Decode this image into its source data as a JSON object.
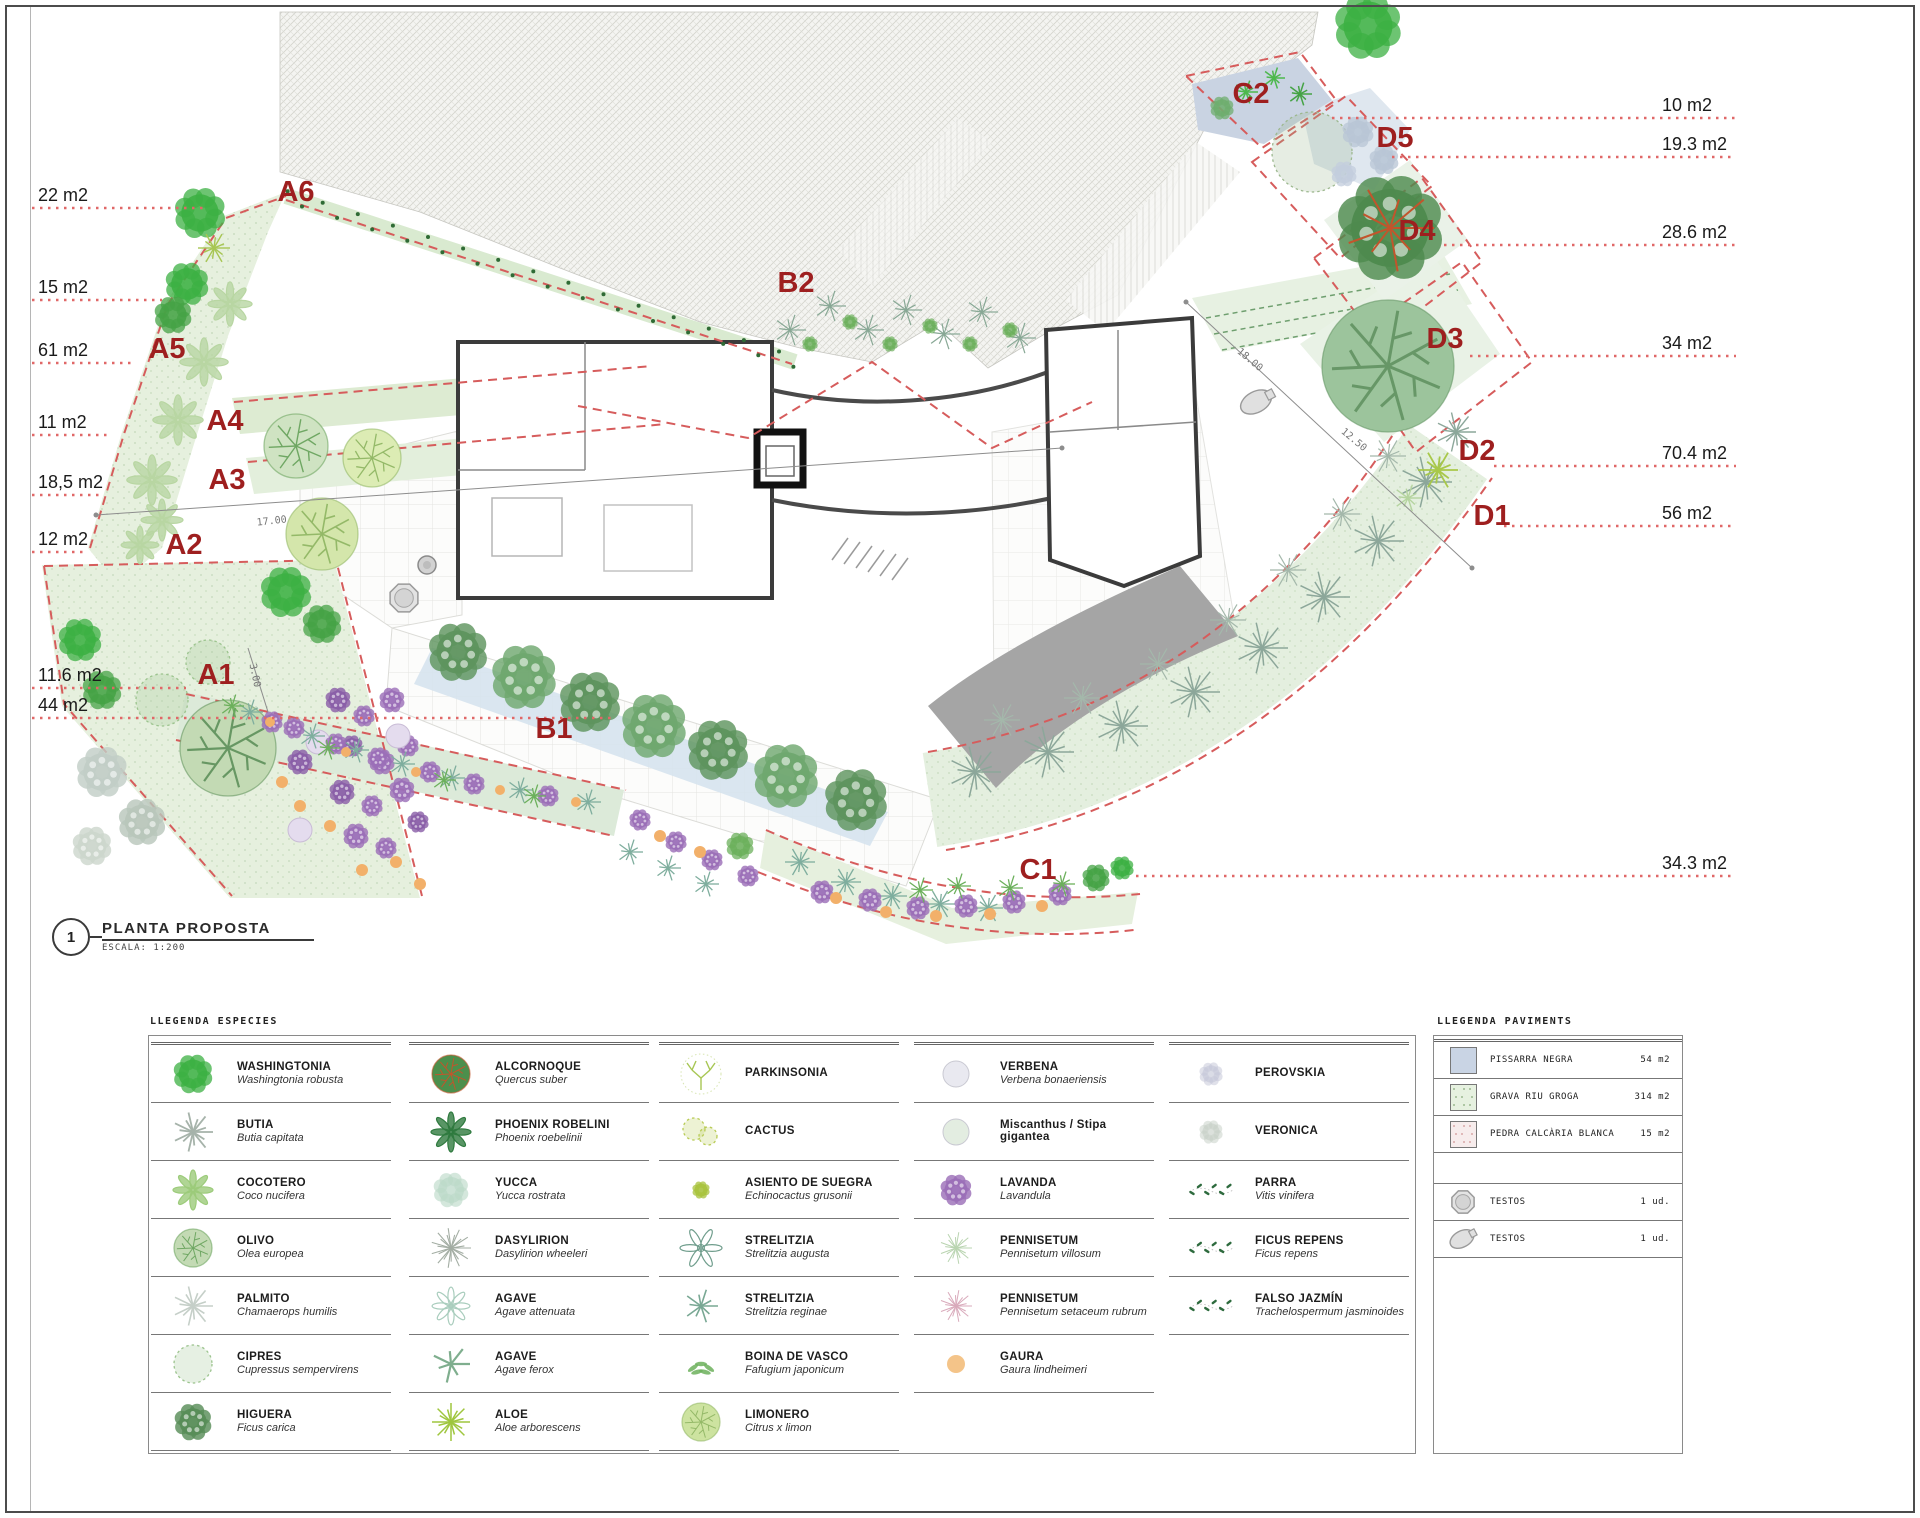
{
  "title_block": {
    "number": "1",
    "title": "PLANTA PROPOSTA",
    "scale_label": "ESCALA:  1:200"
  },
  "colors": {
    "zone_label": "#9e1f1f",
    "leader_line": "#e06868",
    "zone_dash": "#d65c5c"
  },
  "plan": {
    "zones": [
      {
        "id": "A1",
        "label": "A1",
        "x": 216,
        "y": 684
      },
      {
        "id": "A2",
        "label": "A2",
        "x": 184,
        "y": 554
      },
      {
        "id": "A3",
        "label": "A3",
        "x": 227,
        "y": 489
      },
      {
        "id": "A4",
        "label": "A4",
        "x": 225,
        "y": 430
      },
      {
        "id": "A5",
        "label": "A5",
        "x": 167,
        "y": 358
      },
      {
        "id": "A6",
        "label": "A6",
        "x": 296,
        "y": 201
      },
      {
        "id": "B1",
        "label": "B1",
        "x": 554,
        "y": 738
      },
      {
        "id": "B2",
        "label": "B2",
        "x": 796,
        "y": 292
      },
      {
        "id": "C1",
        "label": "C1",
        "x": 1038,
        "y": 879
      },
      {
        "id": "C2",
        "label": "C2",
        "x": 1251,
        "y": 103
      },
      {
        "id": "D1",
        "label": "D1",
        "x": 1492,
        "y": 525
      },
      {
        "id": "D2",
        "label": "D2",
        "x": 1477,
        "y": 460
      },
      {
        "id": "D3",
        "label": "D3",
        "x": 1445,
        "y": 348
      },
      {
        "id": "D4",
        "label": "D4",
        "x": 1417,
        "y": 240
      },
      {
        "id": "D5",
        "label": "D5",
        "x": 1395,
        "y": 147
      }
    ],
    "measurements_left": [
      {
        "label": "22 m2",
        "y": 201,
        "line_y": 208,
        "line_x2": 205
      },
      {
        "label": "15 m2",
        "y": 293,
        "line_y": 300,
        "line_x2": 162
      },
      {
        "label": "61 m2",
        "y": 356,
        "line_y": 363,
        "line_x2": 132
      },
      {
        "label": "11 m2",
        "y": 428,
        "line_y": 435,
        "line_x2": 112
      },
      {
        "label": "18,5 m2",
        "y": 488,
        "line_y": 495,
        "line_x2": 100
      },
      {
        "label": "12 m2",
        "y": 545,
        "line_y": 552,
        "line_x2": 86
      },
      {
        "label": "11.6 m2",
        "y": 681,
        "line_y": 688,
        "line_x2": 186
      },
      {
        "label": "44 m2",
        "y": 711,
        "line_y": 718,
        "line_x2": 612
      }
    ],
    "measurements_right": [
      {
        "label": "10 m2",
        "y": 111,
        "line_x1": 1332
      },
      {
        "label": "19.3 m2",
        "y": 150,
        "line_x1": 1392
      },
      {
        "label": "28.6 m2",
        "y": 238,
        "line_x1": 1444
      },
      {
        "label": "34 m2",
        "y": 349,
        "line_x1": 1470
      },
      {
        "label": "70.4 m2",
        "y": 459,
        "line_x1": 1494
      },
      {
        "label": "56 m2",
        "y": 519,
        "line_x1": 1504
      },
      {
        "label": "34.3 m2",
        "y": 869,
        "line_x1": 1136
      }
    ],
    "dimensions": [
      {
        "label": "17.00",
        "x": 272,
        "y": 524,
        "rot": -6
      },
      {
        "label": "3.00",
        "x": 252,
        "y": 676,
        "rot": 78
      },
      {
        "label": "12.50",
        "x": 1352,
        "y": 442,
        "rot": 40
      },
      {
        "label": "18.00",
        "x": 1248,
        "y": 362,
        "rot": 40
      }
    ]
  },
  "legend_species": {
    "title": "LLEGENDA ESPECIES",
    "columns": [
      {
        "rows": [
          {
            "name": "WASHINGTONIA",
            "latin": "Washingtonia robusta",
            "glyph": "blob-tree",
            "color": "#3cb043"
          },
          {
            "name": "BUTIA",
            "latin": "Butia capitata",
            "glyph": "palm-star",
            "color": "#a6b3aa"
          },
          {
            "name": "COCOTERO",
            "latin": "Coco nucifera",
            "glyph": "palm-fronds",
            "color": "#9ccb7a"
          },
          {
            "name": "OLIVO",
            "latin": "Olea europea",
            "glyph": "olive-tree",
            "color": "#c3dab4",
            "color2": "#6fa763"
          },
          {
            "name": "PALMITO",
            "latin": "Chamaerops humilis",
            "glyph": "snowflake-palm",
            "color": "#c5cfc8"
          },
          {
            "name": "CIPRES",
            "latin": "Cupressus sempervirens",
            "glyph": "dotted-tree",
            "color": "#9cc48e"
          },
          {
            "name": "HIGUERA",
            "latin": "Ficus carica",
            "glyph": "mottled-tree",
            "color": "#578d57"
          }
        ]
      },
      {
        "rows": [
          {
            "name": "ALCORNOQUE",
            "latin": "Quercus suber",
            "glyph": "cork-tree",
            "color": "#4c8f4c",
            "color2": "#c2552c"
          },
          {
            "name": "PHOENIX ROBELINI",
            "latin": "Phoenix roebelinii",
            "glyph": "palm-fronds",
            "color": "#2f7a3f"
          },
          {
            "name": "YUCCA",
            "latin": "Yucca rostrata",
            "glyph": "pompom",
            "color": "#bcd9c9"
          },
          {
            "name": "DASYLIRION",
            "latin": "Dasylirion wheeleri",
            "glyph": "starburst",
            "color": "#a3ada3"
          },
          {
            "name": "AGAVE",
            "latin": "Agave attenuata",
            "glyph": "agave-rosette",
            "color": "#a9cdbd"
          },
          {
            "name": "AGAVE",
            "latin": "Agave ferox",
            "glyph": "agave-blades",
            "color": "#7fae8e"
          },
          {
            "name": "ALOE",
            "latin": "Aloe arborescens",
            "glyph": "aloe-star",
            "color": "#9fc63e"
          }
        ]
      },
      {
        "rows": [
          {
            "name": "PARKINSONIA",
            "latin": "",
            "glyph": "parkinsonia-branches",
            "color": "#a7c653"
          },
          {
            "name": "CACTUS",
            "latin": "",
            "glyph": "cactus-pair",
            "color": "#b8cb55"
          },
          {
            "name": "ASIENTO DE SUEGRA",
            "latin": "Echinocactus grusonii",
            "glyph": "small-blob",
            "color": "#a9c33e"
          },
          {
            "name": "STRELITZIA",
            "latin": "Strelitzia augusta",
            "glyph": "strelitzia-plant",
            "color": "#6f9d8c"
          },
          {
            "name": "STRELITZIA",
            "latin": "Strelitzia reginae",
            "glyph": "strelitzia-star",
            "color": "#79a894"
          },
          {
            "name": "BOINA DE VASCO",
            "latin": "Fafugium japonicum",
            "glyph": "sprig",
            "color": "#6cb05c"
          },
          {
            "name": "LIMONERO",
            "latin": "Citrus x limon",
            "glyph": "citrus-tree",
            "color": "#cde3a0",
            "color2": "#94b968"
          }
        ]
      },
      {
        "rows": [
          {
            "name": "VERBENA",
            "latin": "Verbena bonaeriensis",
            "glyph": "pale-circle",
            "color": "#e9e9f0"
          },
          {
            "name": "Miscanthus / Stipa gigantea",
            "latin": "",
            "glyph": "pale-circle",
            "color": "#e3ede1"
          },
          {
            "name": "LAVANDA",
            "latin": "Lavandula",
            "glyph": "lavender-mottle",
            "color": "#9b6fb8"
          },
          {
            "name": "PENNISETUM",
            "latin": "Pennisetum villosum",
            "glyph": "fine-star",
            "color": "#b9d4b0"
          },
          {
            "name": "PENNISETUM",
            "latin": "Pennisetum setaceum rubrum",
            "glyph": "fine-star",
            "color": "#d9aabb"
          },
          {
            "name": "GAURA",
            "latin": "Gaura lindheimeri",
            "glyph": "orange-dot",
            "color": "#f4c489"
          }
        ]
      },
      {
        "rows": [
          {
            "name": "PEROVSKIA",
            "latin": "",
            "glyph": "sketch-blob",
            "color": "#c6c9d9"
          },
          {
            "name": "VERONICA",
            "latin": "",
            "glyph": "sketch-blob",
            "color": "#c9d1c9"
          },
          {
            "name": "PARRA",
            "latin": "Vitis vinifera",
            "glyph": "vine",
            "color": "#2e6b3e"
          },
          {
            "name": "FICUS REPENS",
            "latin": "Ficus repens",
            "glyph": "vine",
            "color": "#2e6b3e"
          },
          {
            "name": "FALSO JAZMÍN",
            "latin": "Trachelospermum jasminoides",
            "glyph": "vine",
            "color": "#2e6b3e"
          }
        ]
      }
    ]
  },
  "legend_paviments": {
    "title": "LLEGENDA PAVIMENTS",
    "surfaces": [
      {
        "name": "PISSARRA NEGRA",
        "area": "54 m2",
        "swatch": "slate",
        "color": "#c9d4e4"
      },
      {
        "name": "GRAVA RIU GROGA",
        "area": "314 m2",
        "swatch": "gravel-green",
        "color": "#e6f1e0"
      },
      {
        "name": "PEDRA CALCÀRIA BLANCA",
        "area": "15 m2",
        "swatch": "stone-pink",
        "color": "#f7ecec"
      }
    ],
    "pots": [
      {
        "name": "TESTOS",
        "qty": "1 ud.",
        "icon": "pot-octagon"
      },
      {
        "name": "TESTOS",
        "qty": "1 ud.",
        "icon": "pot-amphora"
      }
    ]
  }
}
